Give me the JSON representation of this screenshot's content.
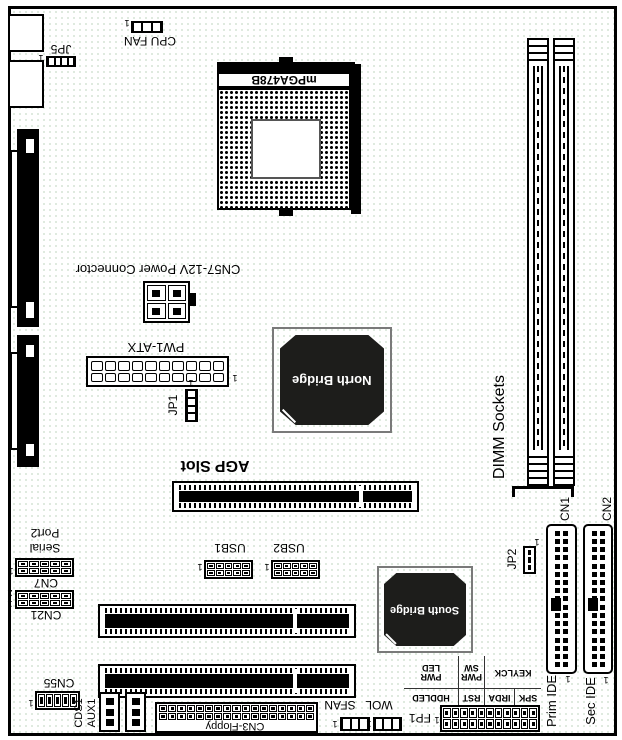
{
  "labels": {
    "jp5": "JP5",
    "cpu_fan": "CPU FAN",
    "socket": "mPGA478B",
    "power_12v": "CN57-12V Power Connector",
    "pw1_atx": "PW1-ATX",
    "jp1": "JP1",
    "north_bridge": "North Bridge",
    "agp_slot": "AGP Slot",
    "dimm_sockets": "DIMM Sockets",
    "cn1": "CN1",
    "cn2": "CN2",
    "jp2": "JP2",
    "south_bridge": "South Bridge",
    "usb1": "USB1",
    "usb2": "USB2",
    "serial_line1": "Serial",
    "serial_line2": "Port2",
    "cn7": "CN7",
    "cn21": "CN21",
    "cn55": "CN55",
    "cds1": "CDS1",
    "aux1": "AUX1",
    "cn3_floppy": "CN3-Floppy",
    "sfan": "SFAN",
    "wol": "WOL",
    "fp1": "FP1",
    "prim_ide": "Prim IDE",
    "sec_ide": "Sec IDE",
    "pin1": "1",
    "pin2": "2"
  },
  "fp": {
    "spk": "SPK",
    "irda": "IRDA",
    "rst": "RST",
    "hddled": "HDDLED",
    "keylck": "KEYLCK",
    "pwr": "PWR",
    "sw": "SW",
    "led": "LED"
  },
  "colors": {
    "line": "#000000",
    "chip_fill": "#1d1d1b",
    "chip_text": "#ffffff",
    "chip_frame": "#7a7a7a",
    "board_speckle": "#d7e5d7",
    "background": "#ffffff"
  }
}
